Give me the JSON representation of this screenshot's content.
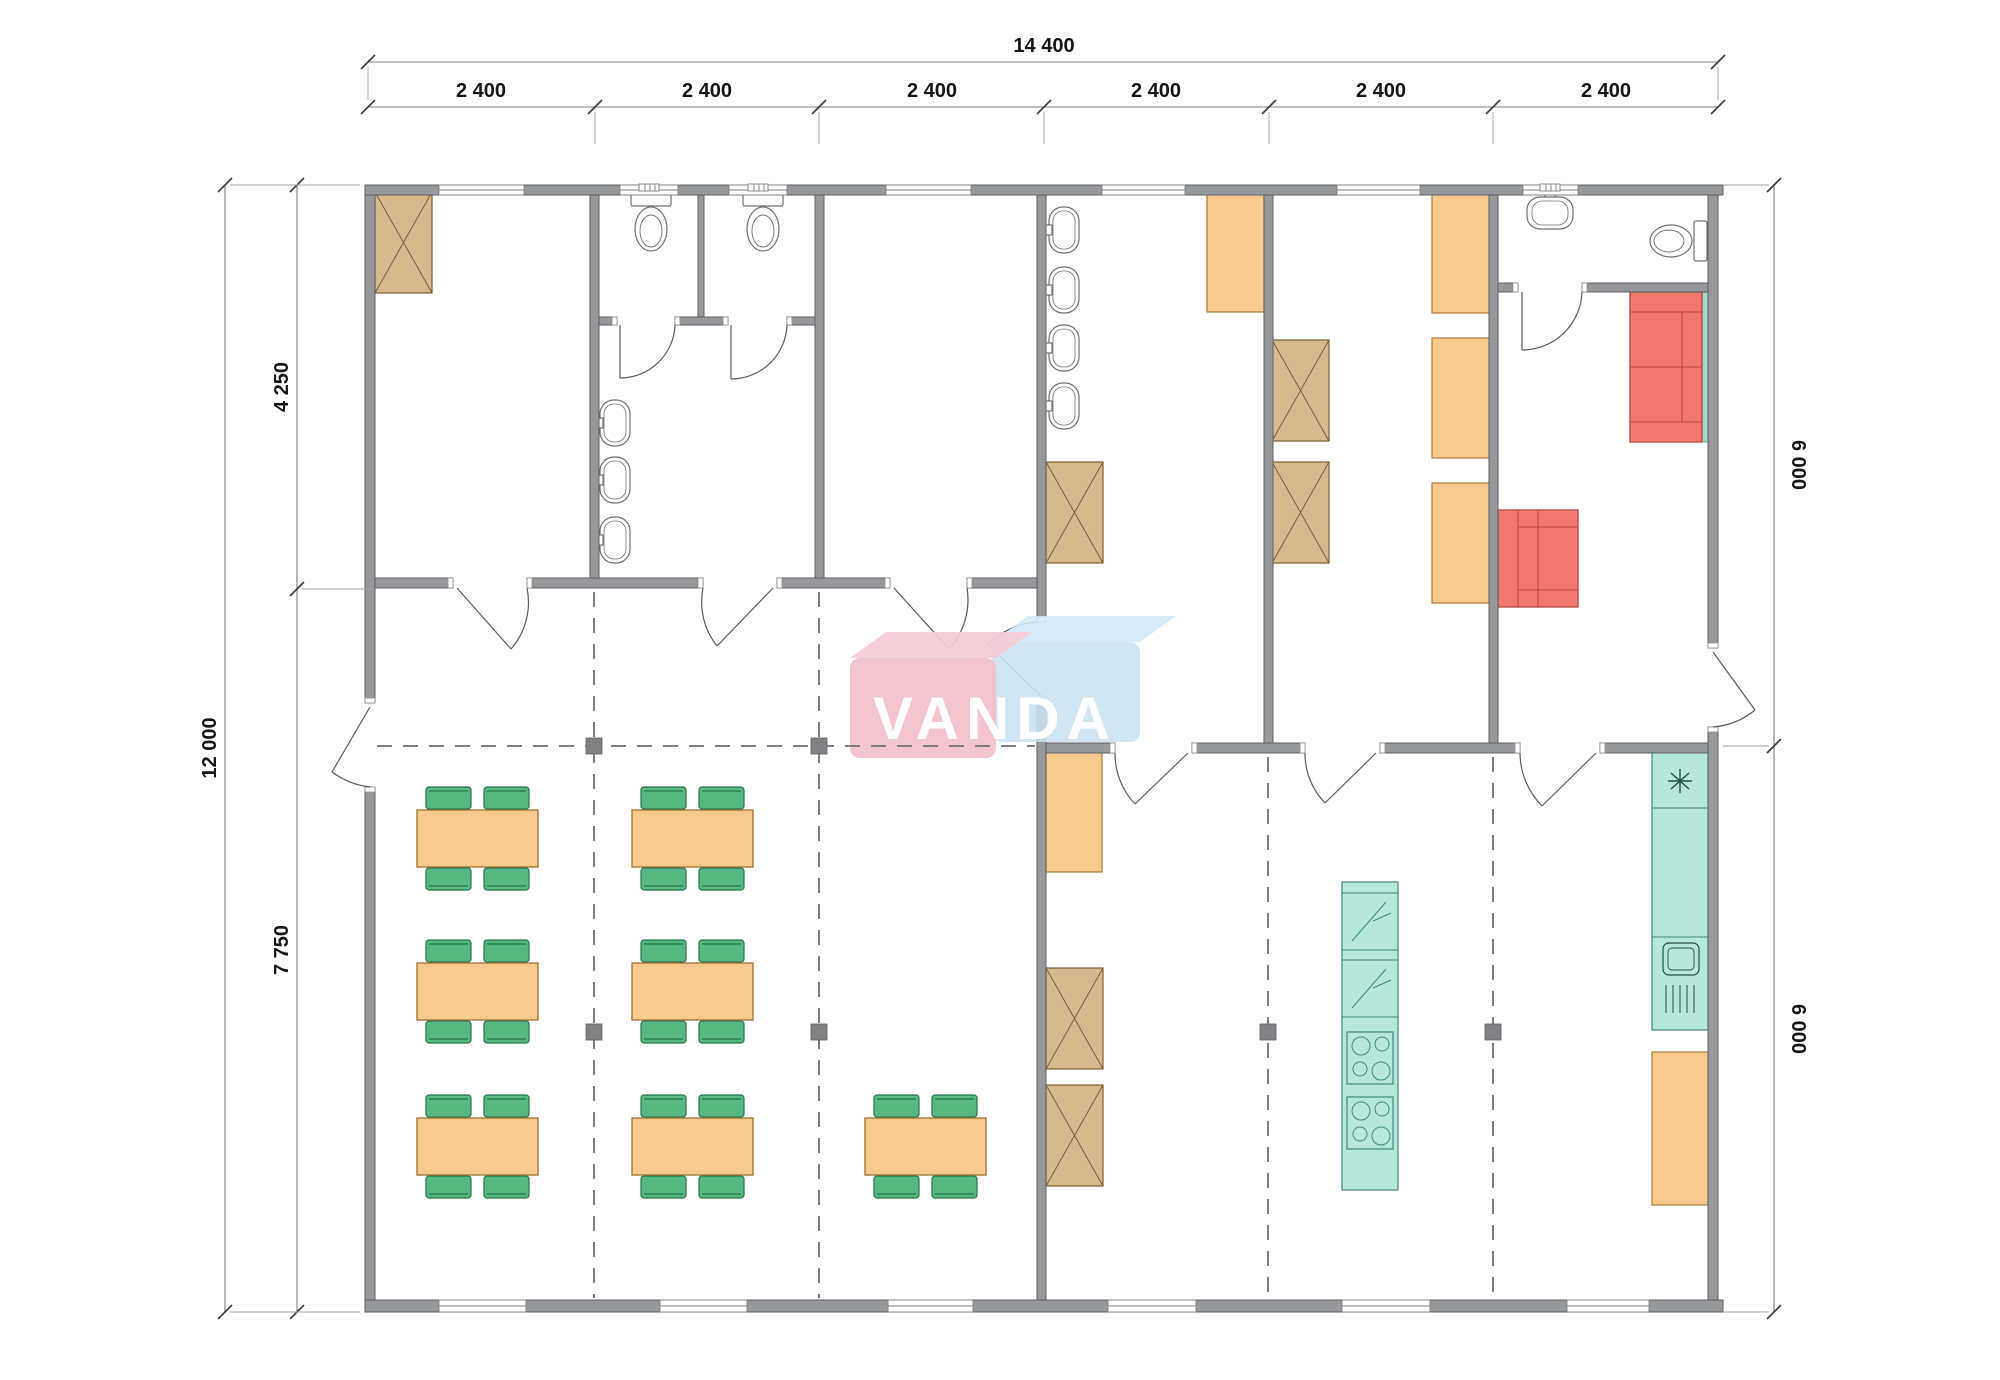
{
  "title": "modular building floor plan",
  "dimensions": {
    "top": {
      "total": "14 400",
      "bays": [
        "2 400",
        "2 400",
        "2 400",
        "2 400",
        "2 400",
        "2 400"
      ]
    },
    "left": {
      "total": "12 000",
      "upper": "4 250",
      "lower": "7 750"
    },
    "right": {
      "upper": "6 000",
      "lower": "6 000"
    }
  },
  "logo": {
    "text": "VANDA",
    "pink": "#f4bfcb",
    "blue": "#cbe2f2"
  },
  "colors": {
    "wall": "#97999c",
    "wardrobe": "#d6ba8e",
    "bed_bench": "#f9ca8e",
    "table": "#f9ca8e",
    "chair": "#57b981",
    "sofa": "#f3796f",
    "kitchen": "#b5e7da",
    "grid": "#6f7173"
  },
  "icons": {
    "wardrobe-icon": "crossed-box",
    "bed-icon": "orange-rectangle",
    "dining-table-icon": "table-with-4-chairs",
    "sofa-icon": "red-sofa",
    "toilet-icon": "tank-and-bowl",
    "sink-icon": "oval-basin",
    "fridge-icon": "box-with-lightning",
    "stove-icon": "box-with-4-burners",
    "freezer-icon": "asterisk-box",
    "kitchen-sink-icon": "basin-with-drainboard",
    "door-icon": "quarter-arc-swing",
    "window-icon": "triple-line-opening",
    "grid-node-icon": "filled-square"
  },
  "furniture_counts": {
    "dining_tables": 7,
    "chairs": 28,
    "wardrobes": 6,
    "beds_benches": 6,
    "sofas": 2,
    "toilets": 3,
    "wash_sinks": 8,
    "kitchen_units": 2
  }
}
